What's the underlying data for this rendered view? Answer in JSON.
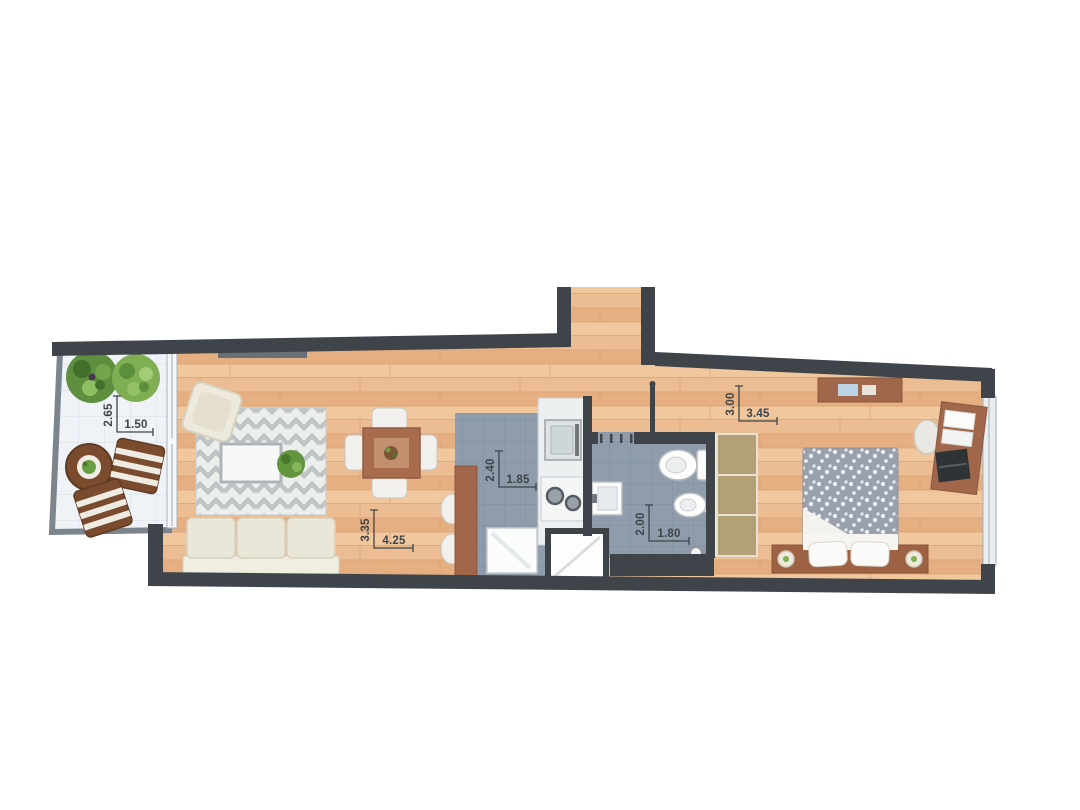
{
  "floorplan": {
    "rooms": {
      "balcony": {
        "dim_v": "2.65",
        "dim_h": "1.50"
      },
      "living_room": {
        "dim_v": "3.35",
        "dim_h": "4.25"
      },
      "kitchen": {
        "dim_v": "2.40",
        "dim_h": "1.85"
      },
      "bathroom": {
        "dim_v": "2.00",
        "dim_h": "1.80"
      },
      "bedroom": {
        "dim_v": "3.00",
        "dim_h": "3.45"
      }
    },
    "colors": {
      "wall": "#3f444a",
      "wood_floor": "#ecbd92",
      "tile_floor": "#8e9cab",
      "balcony_floor": "#eff3f8",
      "furniture_brown": "#a2674a",
      "wardrobe_tan": "#b3a077",
      "sofa_cream": "#ebe7d8",
      "rug_zigzag": "#bdc4c6",
      "duvet_gray": "#98a1ad",
      "plant_green": "#76a24c",
      "dimension_text": "#3f4447"
    }
  }
}
